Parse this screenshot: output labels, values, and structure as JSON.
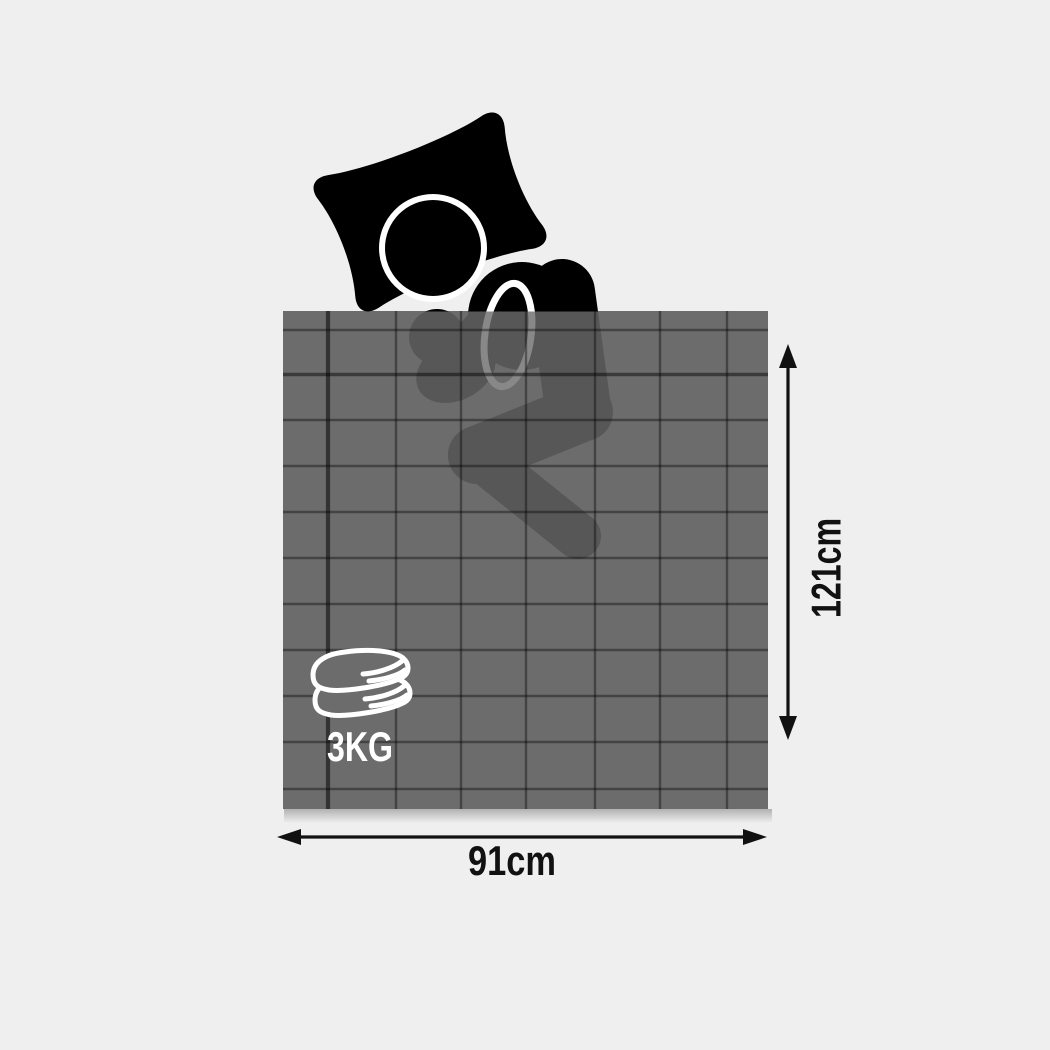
{
  "scene": {
    "background_color": "#efeff0",
    "blanket": {
      "color": "#6c6c6c",
      "grid_line_color": "#3f3f3f",
      "width_label": "91cm",
      "height_label": "121cm"
    },
    "weight_badge": {
      "label": "3KG",
      "icon": "folded-blankets-icon",
      "icon_color": "#ffffff"
    },
    "person": {
      "icon": "sleeping-person-icon",
      "color": "#000000",
      "outline_color": "#ffffff"
    },
    "dimension_labels_color": "#111111"
  }
}
